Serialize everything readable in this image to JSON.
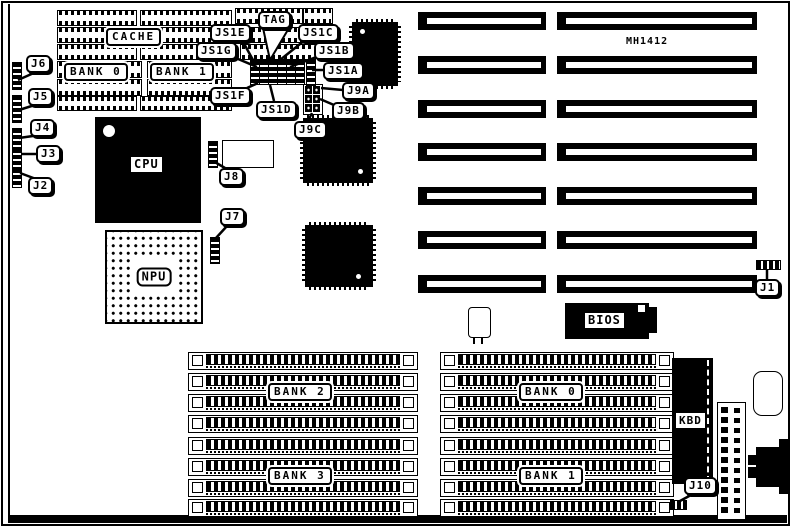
{
  "board": {
    "model": "MH1412",
    "chips": {
      "cpu": "CPU",
      "npu": "NPU",
      "bios": "BIOS",
      "kbd": "KBD",
      "cache": "CACHE",
      "tag": "TAG"
    },
    "banks": {
      "cache_bank0": "BANK 0",
      "cache_bank1": "BANK 1",
      "simm_bank0": "BANK 0",
      "simm_bank1": "BANK 1",
      "simm_bank2": "BANK 2",
      "simm_bank3": "BANK 3"
    },
    "jumpers": {
      "j1": "J1",
      "j2": "J2",
      "j3": "J3",
      "j4": "J4",
      "j5": "J5",
      "j6": "J6",
      "j7": "J7",
      "j8": "J8",
      "j9a": "J9A",
      "j9b": "J9B",
      "j9c": "J9C",
      "j10": "J10",
      "js1a": "JS1A",
      "js1b": "JS1B",
      "js1c": "JS1C",
      "js1d": "JS1D",
      "js1e": "JS1E",
      "js1f": "JS1F",
      "js1g": "JS1G"
    },
    "colors": {
      "ink": "#000000",
      "paper": "#ffffff"
    }
  }
}
